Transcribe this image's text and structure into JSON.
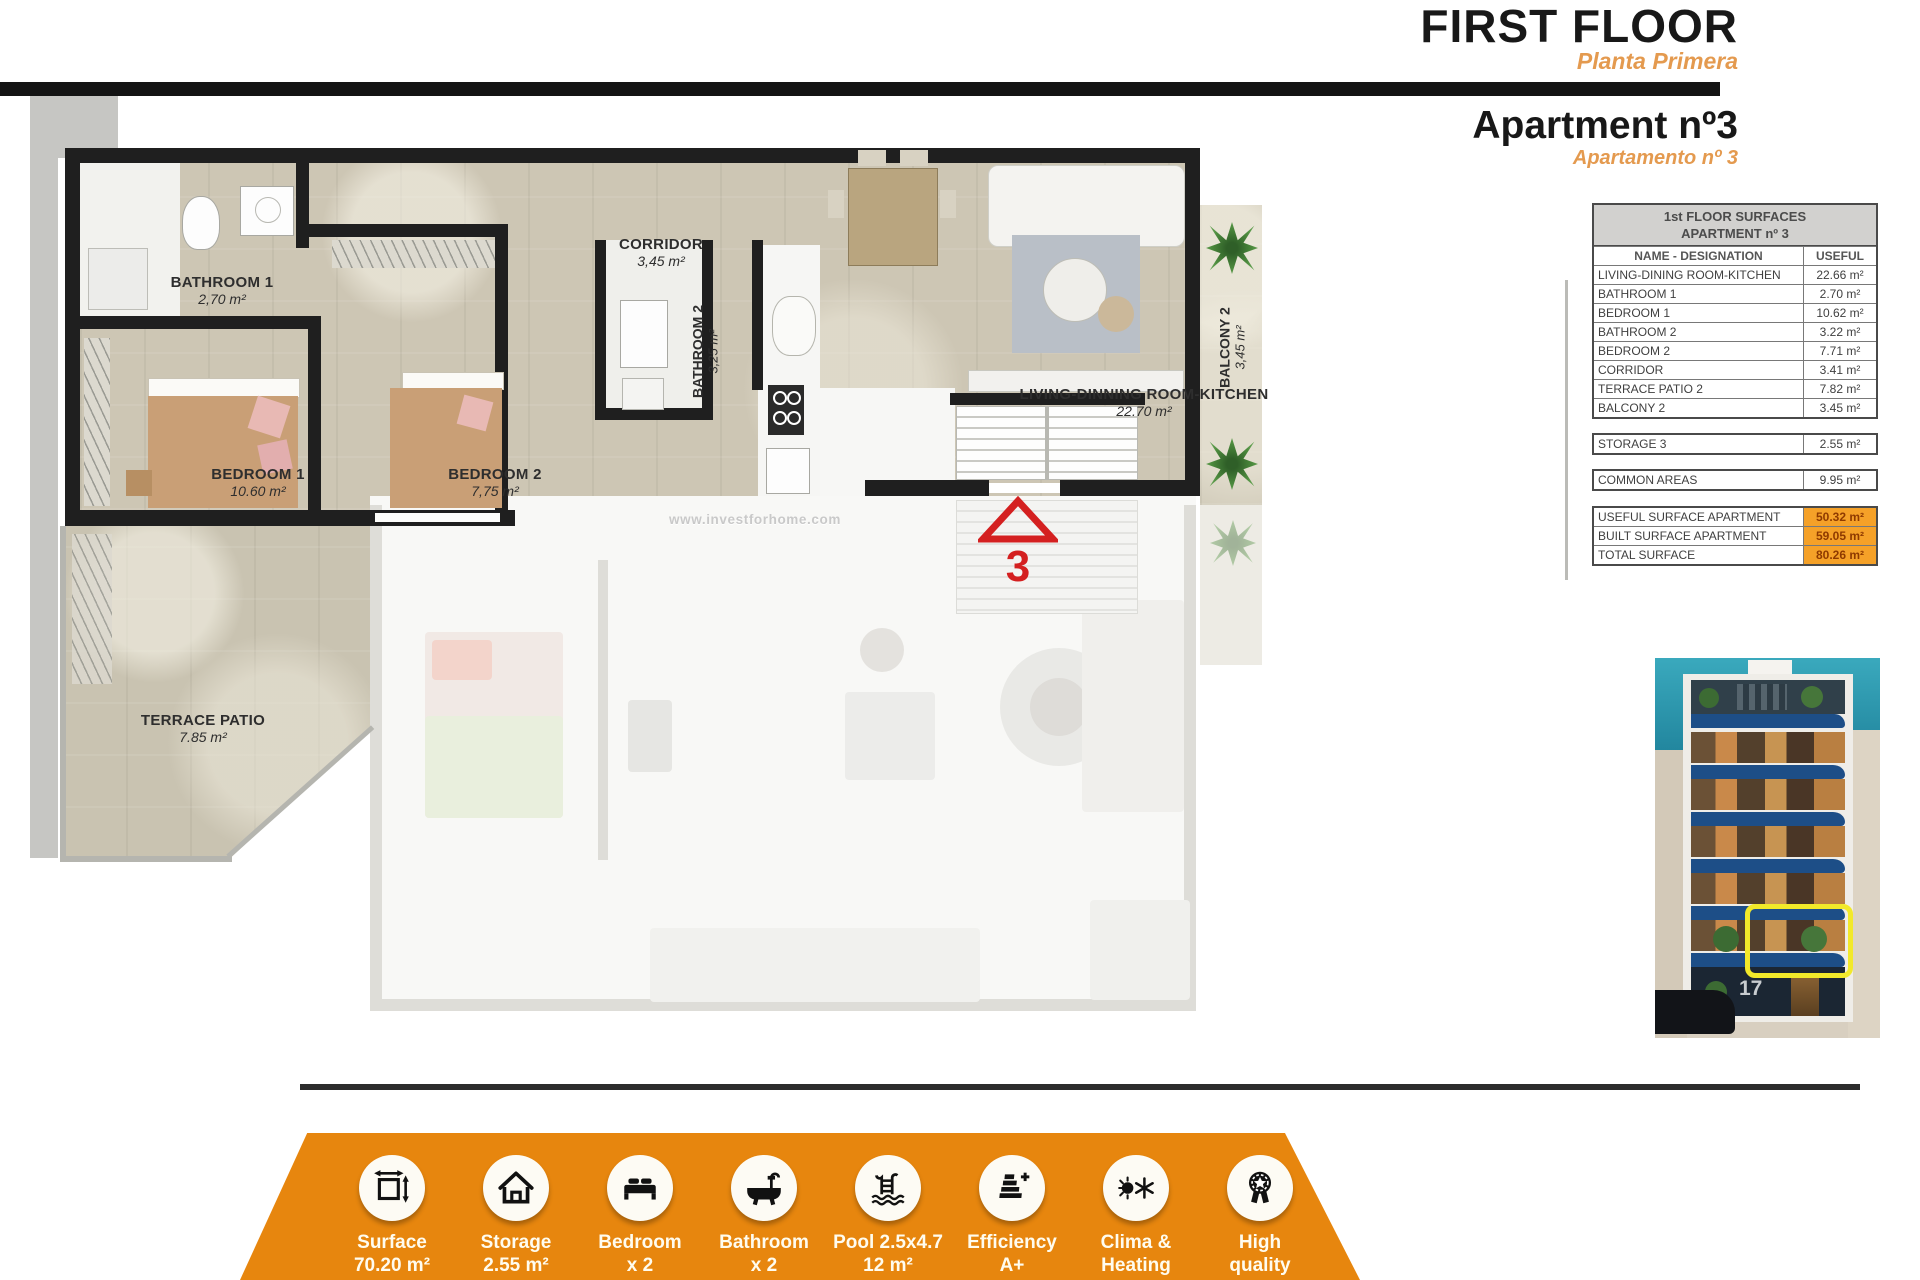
{
  "header": {
    "title": "FIRST FLOOR",
    "subtitle": "Planta Primera",
    "apartment": "Apartment nº3",
    "apartment_sub": "Apartamento nº 3"
  },
  "plan": {
    "watermark": "www.investforhome.com",
    "unit_number": "3",
    "rooms": {
      "bathroom1": {
        "name": "BATHROOM 1",
        "area": "2,70 m²"
      },
      "bedroom1": {
        "name": "BEDROOM 1",
        "area": "10.60 m²"
      },
      "bedroom2": {
        "name": "BEDROOM 2",
        "area": "7,75 m²"
      },
      "corridor": {
        "name": "CORRIDOR",
        "area": "3,45 m²"
      },
      "bathroom2": {
        "name": "BATHROOM 2",
        "area": "3,25 m²"
      },
      "living": {
        "name": "LIVING-DINNING ROOM-KITCHEN",
        "area": "22.70 m²"
      },
      "terrace": {
        "name": "TERRACE PATIO",
        "area": "7.85 m²"
      },
      "balcony": {
        "name": "BALCONY 2",
        "area": "3,45 m²"
      }
    }
  },
  "surfaces_table": {
    "title_line1": "1st FLOOR SURFACES",
    "title_line2": "APARTMENT nº 3",
    "col_name": "NAME - DESIGNATION",
    "col_value": "USEFUL",
    "rows": [
      {
        "name": "LIVING-DINING ROOM-KITCHEN",
        "value": "22.66 m²"
      },
      {
        "name": "BATHROOM 1",
        "value": "2.70 m²"
      },
      {
        "name": "BEDROOM 1",
        "value": "10.62 m²"
      },
      {
        "name": "BATHROOM 2",
        "value": "3.22 m²"
      },
      {
        "name": "BEDROOM 2",
        "value": "7.71 m²"
      },
      {
        "name": "CORRIDOR",
        "value": "3.41 m²"
      },
      {
        "name": "TERRACE PATIO 2",
        "value": "7.82 m²"
      },
      {
        "name": "BALCONY 2",
        "value": "3.45 m²"
      }
    ],
    "storage": {
      "name": "STORAGE 3",
      "value": "2.55 m²"
    },
    "common": {
      "name": "COMMON AREAS",
      "value": "9.95 m²"
    },
    "totals": [
      {
        "name": "USEFUL SURFACE APARTMENT",
        "value": "50.32 m²"
      },
      {
        "name": "BUILT SURFACE APARTMENT",
        "value": "59.05 m²"
      },
      {
        "name": "TOTAL SURFACE",
        "value": "80.26 m²"
      }
    ]
  },
  "photo": {
    "street_number": "17"
  },
  "footer": {
    "items": [
      {
        "icon": "surface-icon",
        "line1": "Surface",
        "line2": "70.20 m²"
      },
      {
        "icon": "storage-icon",
        "line1": "Storage",
        "line2": "2.55 m²"
      },
      {
        "icon": "bedroom-icon",
        "line1": "Bedroom",
        "line2": "x 2"
      },
      {
        "icon": "bathroom-icon",
        "line1": "Bathroom",
        "line2": "x 2"
      },
      {
        "icon": "pool-icon",
        "line1": "Pool 2.5x4.7",
        "line2": "12 m²"
      },
      {
        "icon": "efficiency-icon",
        "line1": "Efficiency",
        "line2": "A+"
      },
      {
        "icon": "clima-icon",
        "line1": "Clima &",
        "line2": "Heating"
      },
      {
        "icon": "quality-icon",
        "line1": "High",
        "line2": "quality"
      }
    ]
  },
  "colors": {
    "accent_orange": "#E7860E",
    "table_highlight": "#F5A128",
    "title_orange": "#E49A4F",
    "marker_red": "#D42020",
    "highlight_yellow": "#F2E92A",
    "wall_black": "#1f1f1f",
    "floor_tan": "#cdc6b4"
  }
}
